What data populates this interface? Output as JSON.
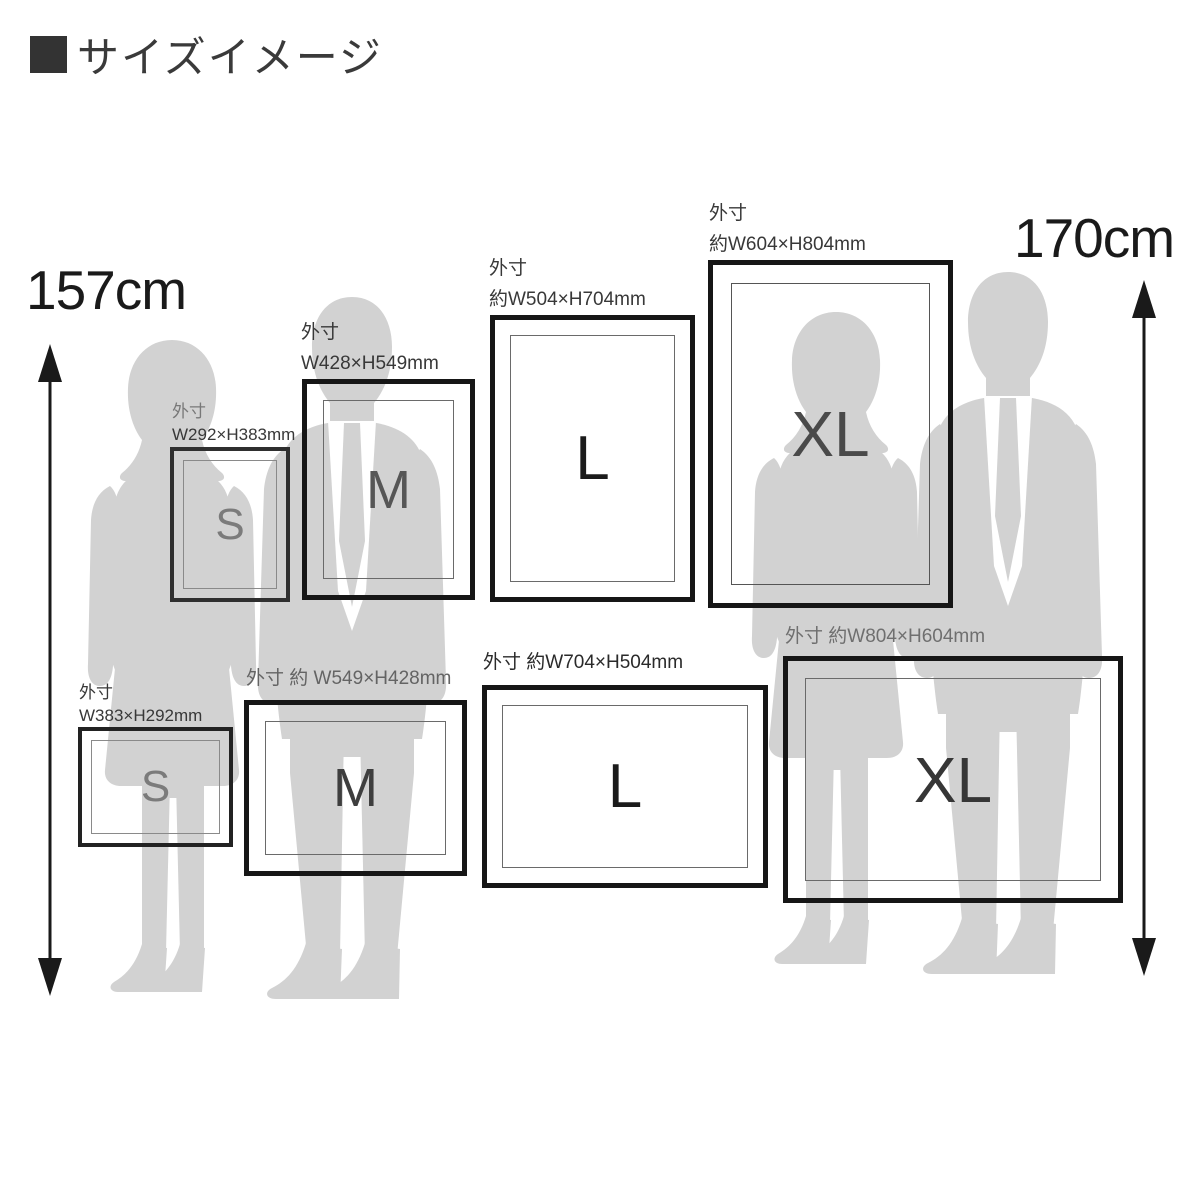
{
  "title": {
    "text": "サイズイメージ"
  },
  "measurements": {
    "female_height": "157cm",
    "male_height": "170cm"
  },
  "frames": [
    {
      "id": "s-portrait",
      "letter": "S",
      "label_line1": "外寸",
      "label_line2": "W292×H383mm"
    },
    {
      "id": "m-portrait",
      "letter": "M",
      "label_line1": "外寸",
      "label_line2": "W428×H549mm"
    },
    {
      "id": "l-portrait",
      "letter": "L",
      "label_line1": "外寸",
      "label_line2": "約W504×H704mm"
    },
    {
      "id": "xl-portrait",
      "letter": "XL",
      "label_line1": "外寸",
      "label_line2": "約W604×H804mm"
    },
    {
      "id": "s-landscape",
      "letter": "S",
      "label_line1": "外寸",
      "label_line2": "W383×H292mm"
    },
    {
      "id": "m-landscape",
      "letter": "M",
      "label_line1": "外寸 約 W549×H428mm",
      "label_line2": ""
    },
    {
      "id": "l-landscape",
      "letter": "L",
      "label_line1": "外寸 約W704×H504mm",
      "label_line2": ""
    },
    {
      "id": "xl-landscape",
      "letter": "XL",
      "label_line1": "外寸 約W804×H604mm",
      "label_line2": ""
    }
  ],
  "colors": {
    "silhouette": "#d2d2d2",
    "frame_border": "#161616",
    "text_dark": "#1a1a1a",
    "background": "#ffffff"
  }
}
